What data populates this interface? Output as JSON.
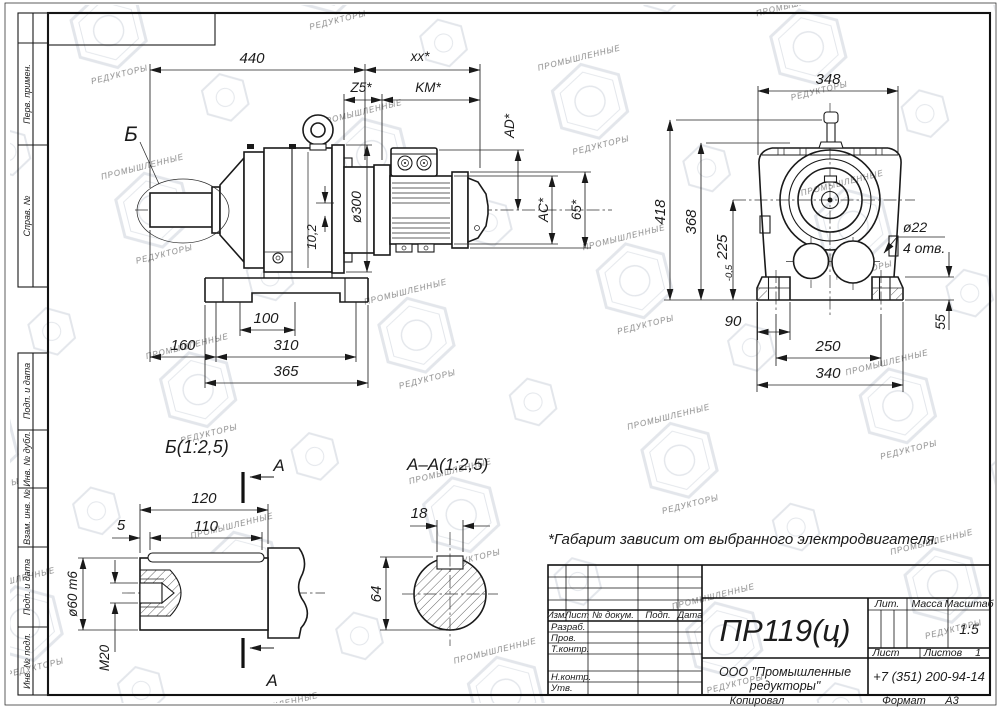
{
  "watermark": {
    "line1": "ПРОМЫШЛЕННЫЕ",
    "line2": "РЕДУКТОРЫ"
  },
  "sheet": {
    "side_labels": [
      "Перв. примен.",
      "Справ. №",
      "Подп. и дата",
      "Инв. № дубл.",
      "Взам. инв. №",
      "Подп. и дата",
      "Инв. № подл."
    ],
    "note": "*Габарит зависит от выбранного электродвигателя."
  },
  "main_view": {
    "callout": "Б",
    "dim_440": "440",
    "dim_xx": "xx*",
    "dim_z5": "Z5*",
    "dim_km": "KM*",
    "dim_ad": "AD*",
    "dim_ac": "AC*",
    "dim_65": "65*",
    "dim_d300": "ø300",
    "dim_102": "10,2",
    "dim_100": "100",
    "dim_310": "310",
    "dim_365": "365",
    "dim_160": "160"
  },
  "front_view": {
    "dim_348": "348",
    "dim_418": "418",
    "dim_368": "368",
    "dim_225": "225",
    "dim_225_tol": "-0,5",
    "dim_d22": "ø22",
    "dim_holes": "4 отв.",
    "dim_90": "90",
    "dim_250": "250",
    "dim_340": "340",
    "dim_55": "55"
  },
  "detail_b": {
    "title": "Б(1:2,5)",
    "section_letter": "А",
    "dim_120": "120",
    "dim_110": "110",
    "dim_5": "5",
    "dim_d60": "ø60 m6",
    "dim_m20": "М20"
  },
  "section_aa": {
    "title": "А–А(1:2,5)",
    "dim_18": "18",
    "dim_64": "64"
  },
  "title_block": {
    "change_header": [
      "Изм.",
      "Лист",
      "№ докум.",
      "Подп.",
      "Дата"
    ],
    "roles": [
      "Разраб.",
      "Пров.",
      "Т.контр.",
      "Н.контр.",
      "Утв."
    ],
    "doc_number": "ПР119(ц)",
    "lit": "Лит.",
    "mass": "Масса",
    "scale": "Масштаб",
    "scale_value": "1:5",
    "sheet": "Лист",
    "sheets": "Листов",
    "sheets_value": "1",
    "company_1": "ООО \"Промышленные",
    "company_2": "редукторы\"",
    "phone": "+7 (351) 200-94-14",
    "copied": "Копировал",
    "format": "Формат",
    "format_value": "А3"
  }
}
